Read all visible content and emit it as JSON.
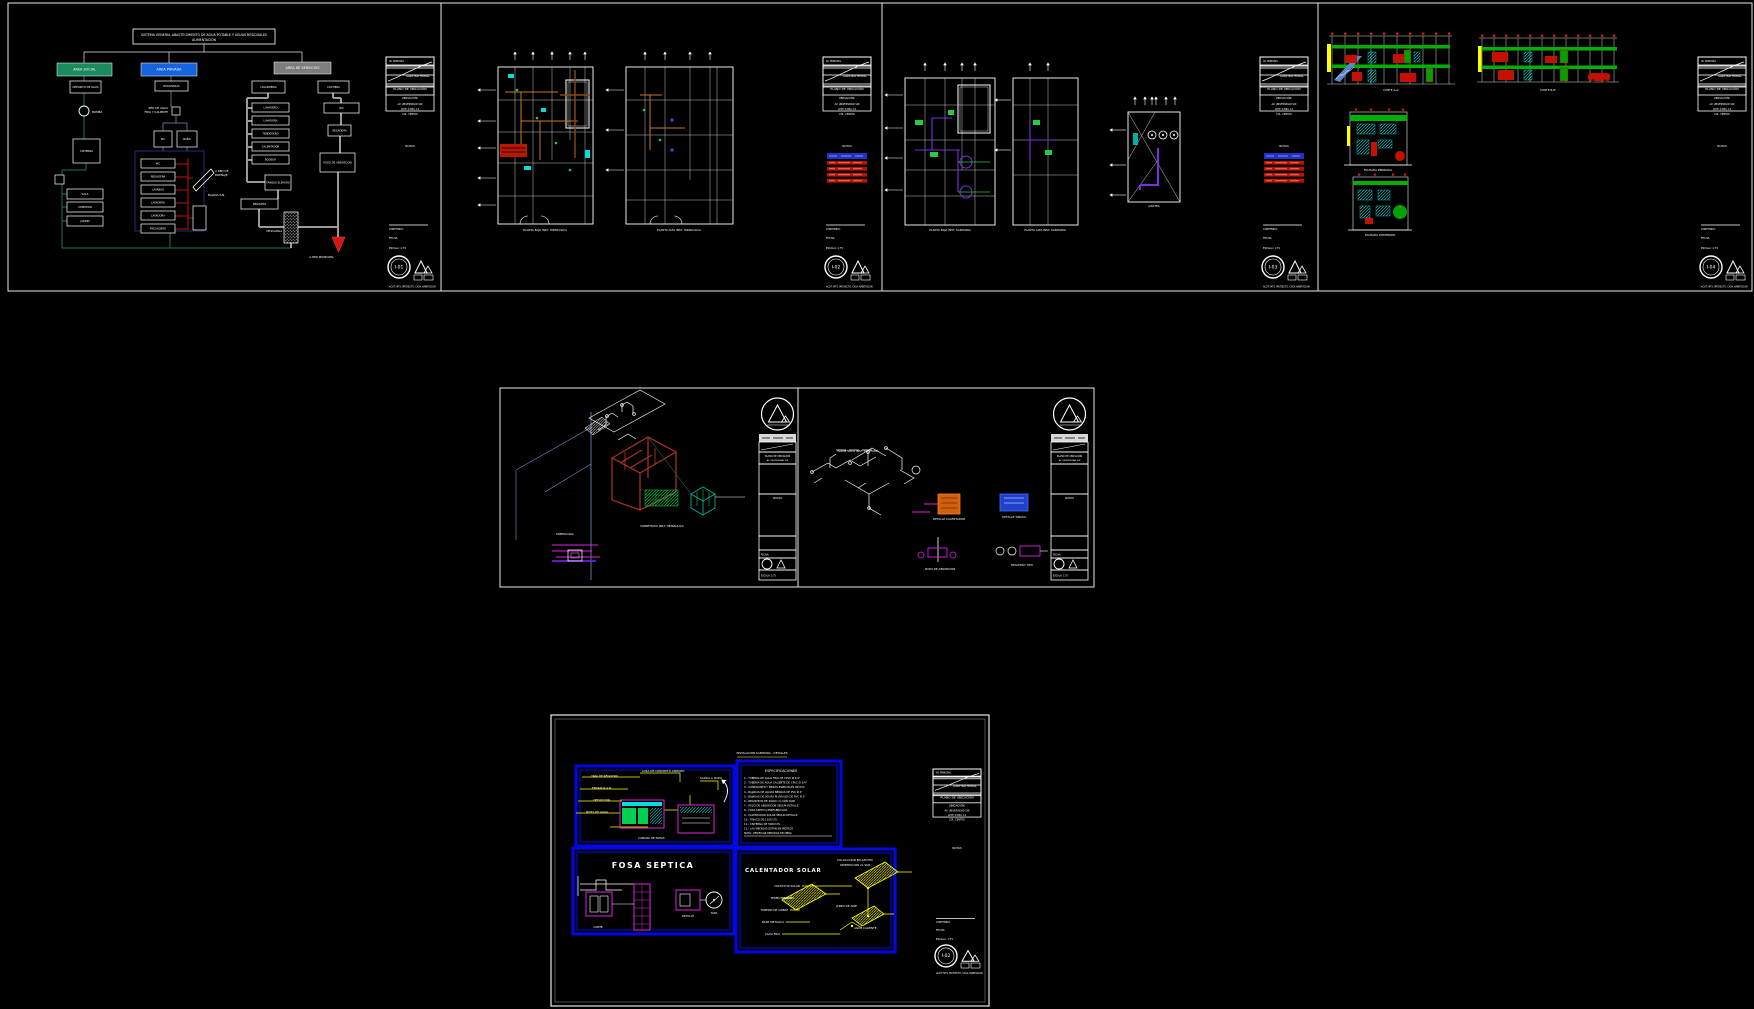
{
  "palette": {
    "bg": "#000000",
    "line": "#ffffff",
    "teal": "#1d6f5f",
    "green_area": "#1c8a5f",
    "blue_area": "#1465dd",
    "gray_area": "#7d7d7d",
    "red": "#cc1400",
    "dark_red": "#a03020",
    "orange": "#c87828",
    "brown": "#8a4a10",
    "cyan": "#00dede",
    "green": "#22cc44",
    "purple": "#7a30e0",
    "magenta": "#e020e0",
    "yellow": "#ffff00",
    "panel_blue": "#0008e8",
    "legend_blue": "#2030c8",
    "steel": "#7a90c8",
    "teal_cube": "#00b0a0"
  },
  "title_block": {
    "croquis_a": "AV. PRINCIPAL",
    "croquis_b": "CARRETERA FEDERAL",
    "plano": "PLANO DE UBICACIÓN",
    "ubicacion_title": "UBICACIÓN:",
    "ubicacion_l1": "AV. UNIVERSIDAD S/N",
    "ubicacion_l2": "LOTE 4  MZA. 12",
    "ubicacion_l3": "COL. CENTRO",
    "notas": "NOTAS",
    "contenido": "CONTENIDO:",
    "fecha": "FECHA:",
    "escala": "ESCALA: 1:75",
    "acot": "ACOT: MTS.",
    "firma": "PROYECTO: CASA HABITACION"
  },
  "tb_configs": [
    {
      "ox": 386,
      "oy": 57,
      "s": 1,
      "num": "I-01",
      "legend": false
    },
    {
      "ox": 823,
      "oy": 57,
      "s": 1,
      "num": "I-02",
      "legend": true
    },
    {
      "ox": 1260,
      "oy": 57,
      "s": 1,
      "num": "I-03",
      "legend": true
    },
    {
      "ox": 1698,
      "oy": 57,
      "s": 1,
      "num": "I-04",
      "legend": false
    },
    {
      "ox": 933,
      "oy": 769,
      "s": 0.89,
      "num": "I-02",
      "legend": false
    }
  ],
  "tb_mid": [
    {
      "ox": 759,
      "oy": 396
    },
    {
      "ox": 1051,
      "oy": 396
    }
  ],
  "sheets": {
    "a": {
      "title_l1": "SISTEMA GENERAL ABASTECIMIENTO DE AGUA POTABLE Y AGUAS RESIDUALES",
      "title_l2": "ALIMENTACIÓN",
      "areas": [
        {
          "label": "AREA SOCIAL",
          "x": 57,
          "y": 63,
          "w": 55,
          "h": 13,
          "fill": "#1c8a5f"
        },
        {
          "label": "AREA PRIVADA",
          "x": 141,
          "y": 63,
          "w": 56,
          "h": 13,
          "fill": "#1465dd"
        },
        {
          "label": "AREA DE SERVICIOS",
          "x": 274,
          "y": 62,
          "w": 57,
          "h": 12,
          "fill": "#7d7d7d"
        }
      ],
      "nodes": [
        {
          "label": "DEPOSITO DE AGUA",
          "x": 70,
          "y": 81,
          "w": 31,
          "h": 12
        },
        {
          "label": "CISTERNA",
          "x": 73,
          "y": 139,
          "w": 27,
          "h": 24
        },
        {
          "label": "",
          "x": 55,
          "y": 175,
          "w": 9,
          "h": 9
        },
        {
          "label": "SALA",
          "x": 67,
          "y": 189,
          "w": 36,
          "h": 10
        },
        {
          "label": "COMEDOR",
          "x": 67,
          "y": 202,
          "w": 36,
          "h": 10
        },
        {
          "label": "JARDIN",
          "x": 67,
          "y": 216,
          "w": 36,
          "h": 10
        },
        {
          "label": "RECAMARAS",
          "x": 155,
          "y": 81,
          "w": 33,
          "h": 10
        },
        {
          "label": "",
          "x": 172,
          "y": 107,
          "w": 8,
          "h": 8
        },
        {
          "label": "WC",
          "x": 154,
          "y": 131,
          "w": 18,
          "h": 16
        },
        {
          "label": "BAÑO",
          "x": 177,
          "y": 131,
          "w": 20,
          "h": 16
        },
        {
          "label": "WC",
          "x": 141,
          "y": 159,
          "w": 34,
          "h": 9
        },
        {
          "label": "REGADERA",
          "x": 141,
          "y": 172,
          "w": 34,
          "h": 9
        },
        {
          "label": "LAVABOS",
          "x": 141,
          "y": 185,
          "w": 34,
          "h": 9
        },
        {
          "label": "LAVADERO",
          "x": 141,
          "y": 198,
          "w": 34,
          "h": 9
        },
        {
          "label": "LAVADORA",
          "x": 141,
          "y": 211,
          "w": 34,
          "h": 9
        },
        {
          "label": "FREGADERO",
          "x": 141,
          "y": 224,
          "w": 34,
          "h": 9
        },
        {
          "label": "",
          "x": 193,
          "y": 206,
          "w": 13,
          "h": 24
        },
        {
          "label": "LAVANDERIA",
          "x": 252,
          "y": 81,
          "w": 33,
          "h": 12
        },
        {
          "label": "COCHERA",
          "x": 318,
          "y": 81,
          "w": 31,
          "h": 12
        },
        {
          "label": "LAVADERO",
          "x": 252,
          "y": 103,
          "w": 37,
          "h": 9
        },
        {
          "label": "LAVADORA",
          "x": 252,
          "y": 116,
          "w": 37,
          "h": 9
        },
        {
          "label": "TENDEDERO",
          "x": 252,
          "y": 129,
          "w": 37,
          "h": 9
        },
        {
          "label": "CALENTADOR",
          "x": 252,
          "y": 142,
          "w": 37,
          "h": 9
        },
        {
          "label": "BODEGA",
          "x": 252,
          "y": 155,
          "w": 37,
          "h": 9
        },
        {
          "label": "WC",
          "x": 324,
          "y": 103,
          "w": 35,
          "h": 10
        },
        {
          "label": "REGADERA",
          "x": 328,
          "y": 125,
          "w": 23,
          "h": 11
        },
        {
          "label": "POZO DE ABSORCION",
          "x": 320,
          "y": 153,
          "w": 35,
          "h": 19
        },
        {
          "label": "TANQUE ELEVADO",
          "x": 265,
          "y": 175,
          "w": 26,
          "h": 15
        },
        {
          "label": "REGISTRO",
          "x": 241,
          "y": 199,
          "w": 37,
          "h": 10
        }
      ]
    },
    "bottom": {
      "fosa_title": "FOSA SEPTICA",
      "cal_title": "CALENTADOR SOLAR",
      "espec_title": "ESPECIFICACIONES",
      "spec_lines": [
        "1.-  TUBERIA DE AGUA FRIA DE CPVC Ø 1/2\"",
        "2.-  TUBERIA DE AGUA CALIENTE DE CPVC Ø 3/4\"",
        "3.-  CONEXIONES Y PIEZAS ESPECIALES DE PVC",
        "4.-  BAJADAS DE AGUAS NEGRAS DE PVC Ø 4\"",
        "5.-  BAJADAS DE AGUAS PLUVIALES DE PVC Ø 3\"",
        "6.-  REGISTROS DE 40x60 cm CON TAPA",
        "7.-  POZO DE ABSORCION SEGUN DETALLE",
        "8.-  FOSA SEPTICA PREFABRICADA",
        "9.-  CALENTADOR SOLAR SEGUN DETALLE",
        "10.- TINACO DE 1100 LTS.",
        "11.- CISTERNA DE 5000 LTS.",
        "12.- LAS MEDIDAS ESTAN EN METROS",
        "NOTA: VERIFICAR MEDIDAS EN OBRA"
      ]
    }
  },
  "annotations": [
    {
      "x": 92,
      "y": 113,
      "t": "BOMBA"
    },
    {
      "x": 168,
      "y": 109,
      "t": "RED DE AGUA",
      "a": "end"
    },
    {
      "x": 168,
      "y": 113,
      "t": "FRIA Y CALIENTE",
      "a": "end"
    },
    {
      "x": 215,
      "y": 172,
      "t": "A RED DE"
    },
    {
      "x": 215,
      "y": 176,
      "t": "DRENAJE"
    },
    {
      "x": 208,
      "y": 196,
      "t": "BAJADA A.N."
    },
    {
      "x": 282,
      "y": 232,
      "t": "DESCARGA",
      "a": "end"
    },
    {
      "x": 334,
      "y": 258,
      "t": "A RED MUNICIPAL",
      "a": "end"
    },
    {
      "x": 545,
      "y": 231,
      "t": "PLANTA BAJA INST. HIDRAULICA",
      "a": "middle"
    },
    {
      "x": 679,
      "y": 231,
      "t": "PLANTA ALTA INST. HIDRAULICA",
      "a": "middle"
    },
    {
      "x": 950,
      "y": 231,
      "t": "PLANTA BAJA INST. SANITARIA",
      "a": "middle"
    },
    {
      "x": 1045,
      "y": 231,
      "t": "PLANTA ALTA INST. SANITARIA",
      "a": "middle"
    },
    {
      "x": 1154,
      "y": 207,
      "t": "AZOTEA",
      "a": "middle"
    },
    {
      "x": 1391,
      "y": 91,
      "t": "CORTE A-A'",
      "a": "middle"
    },
    {
      "x": 1548,
      "y": 91,
      "t": "CORTE B-B'",
      "a": "middle"
    },
    {
      "x": 1378,
      "y": 171,
      "t": "FACHADA PRINCIPAL",
      "a": "middle"
    },
    {
      "x": 1380,
      "y": 236,
      "t": "FACHADA POSTERIOR",
      "a": "middle"
    },
    {
      "x": 662,
      "y": 527,
      "t": "ISOMETRICO INST. HIDRAULICA",
      "a": "middle"
    },
    {
      "x": 858,
      "y": 452,
      "t": "ISOMETRICO INST. SANITARIA",
      "a": "middle"
    },
    {
      "x": 949,
      "y": 520,
      "t": "DETALLE CALENTADOR",
      "a": "middle",
      "f": "#e020e0"
    },
    {
      "x": 1014,
      "y": 518,
      "t": "DETALLE TINACO",
      "a": "middle"
    },
    {
      "x": 940,
      "y": 570,
      "t": "POZO DE ABSORCION",
      "a": "middle",
      "f": "#e020e0"
    },
    {
      "x": 1022,
      "y": 566,
      "t": "REGISTRO TIPO",
      "a": "middle",
      "f": "#e020e0"
    },
    {
      "x": 556,
      "y": 535,
      "t": "SIMBOLOGIA",
      "f": "#e020e0"
    },
    {
      "x": 618,
      "y": 777,
      "t": "TAPA DE REGISTRO",
      "a": "end",
      "f": "#ffff00"
    },
    {
      "x": 612,
      "y": 789,
      "t": "ENTRADA A.N.",
      "a": "end",
      "f": "#ffff00"
    },
    {
      "x": 610,
      "y": 801,
      "t": "DEFLECTOR",
      "a": "end",
      "f": "#ffff00"
    },
    {
      "x": 608,
      "y": 813,
      "t": "NIVEL DE AGUA",
      "a": "end",
      "f": "#ffff00"
    },
    {
      "x": 642,
      "y": 772,
      "t": "LOSA DE CONCRETO ARMADO",
      "f": "#ffff00"
    },
    {
      "x": 700,
      "y": 779,
      "t": "SALIDA A POZO",
      "f": "#ffff00"
    },
    {
      "x": 638,
      "y": 839,
      "t": "CAMARA DE NATAS",
      "f": "#ffff00"
    },
    {
      "x": 762,
      "y": 754,
      "t": "INSTALACION SANITARIA - DETALLES",
      "a": "middle",
      "f": "#ffff00"
    },
    {
      "x": 598,
      "y": 928,
      "t": "CORTE",
      "a": "middle"
    },
    {
      "x": 688,
      "y": 917,
      "t": "DETALLE",
      "a": "middle"
    },
    {
      "x": 714,
      "y": 914,
      "t": "TAPA",
      "a": "middle"
    },
    {
      "x": 855,
      "y": 861,
      "t": "COLOCACION EN AZOTEA",
      "a": "middle",
      "f": "#ffff00"
    },
    {
      "x": 855,
      "y": 866,
      "t": "ORIENTACION AL SUR",
      "a": "middle",
      "f": "#ffff00"
    },
    {
      "x": 800,
      "y": 887,
      "t": "COLECTOR SOLAR",
      "a": "end",
      "f": "#ffff00"
    },
    {
      "x": 792,
      "y": 899,
      "t": "TERMOTANQUE",
      "a": "end",
      "f": "#ffff00"
    },
    {
      "x": 788,
      "y": 911,
      "t": "TUBERIA DE COBRE",
      "a": "end",
      "f": "#ffff00"
    },
    {
      "x": 784,
      "y": 923,
      "t": "BASE METALICA",
      "a": "end",
      "f": "#ffff00"
    },
    {
      "x": 780,
      "y": 935,
      "t": "AGUA FRIA",
      "a": "end",
      "f": "#ffff00"
    },
    {
      "x": 836,
      "y": 907,
      "t": "JARRO DE AIRE",
      "f": "#ffff00"
    },
    {
      "x": 854,
      "y": 929,
      "t": "AGUA CALIENTE",
      "f": "#ffff00"
    }
  ]
}
